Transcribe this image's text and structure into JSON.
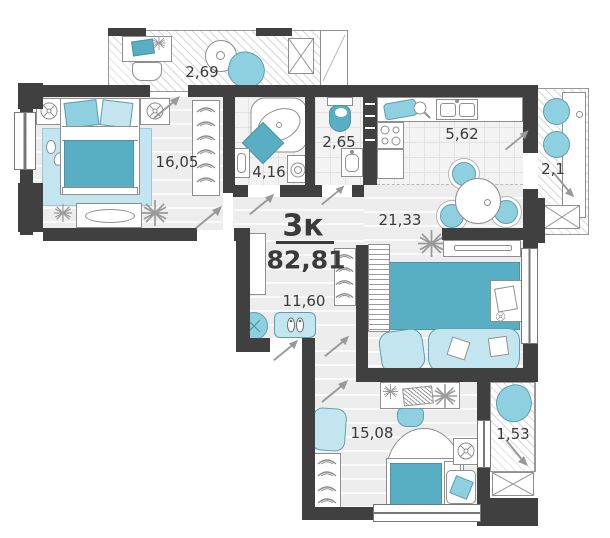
{
  "plan": {
    "apartment_type": "3к",
    "total_area": "82,81",
    "rooms": {
      "balcony_top": "2,69",
      "bedroom_main": "16,05",
      "bathroom": "4,16",
      "wc": "2,65",
      "kitchen": "5,62",
      "loggia_right": "2,1",
      "kitchen_living": "21,33",
      "hallway": "11,60",
      "bedroom_second": "15,08",
      "loggia_bottom": "1,53"
    },
    "icons": {
      "plant-icon": "radiating-lines star",
      "fan-icon": "circle with cross",
      "door-swing-arrow-icon": "diagonal arrow",
      "hanger-icon": "arc hook",
      "crossed-box-icon": "rectangle with X"
    }
  },
  "colors": {
    "wall": "#404040",
    "accent": "#58afc3",
    "accent_mid": "#8fd0e0",
    "accent_light": "#c3e5ef",
    "outline": "#8f8f8f",
    "text": "#3a3a3a",
    "floor": "#ededed"
  }
}
